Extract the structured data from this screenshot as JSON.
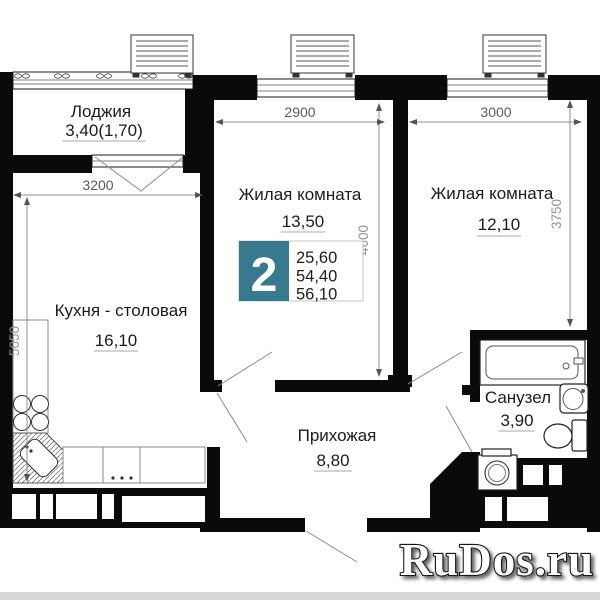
{
  "rooms": [
    {
      "key": "loggia",
      "name": "Лоджия",
      "area": "3,40(1,70)"
    },
    {
      "key": "living1",
      "name": "Жилая комната",
      "area": "13,50"
    },
    {
      "key": "living2",
      "name": "Жилая комната",
      "area": "12,10"
    },
    {
      "key": "kitchen",
      "name": "Кухня - столовая",
      "area": "16,10"
    },
    {
      "key": "hallway",
      "name": "Прихожая",
      "area": "8,80"
    },
    {
      "key": "bathroom",
      "name": "Санузел",
      "area": "3,90"
    }
  ],
  "badge": {
    "room_count": "2",
    "values": [
      "25,60",
      "54,40",
      "56,10"
    ]
  },
  "dims": {
    "living1_width": "2900",
    "living2_width": "3000",
    "kitchen_width": "3200",
    "living1_depth": "4600",
    "living2_depth": "3750",
    "kitchen_depth": "5050"
  },
  "watermark": {
    "text": "RuDos.ru"
  },
  "colors": {
    "badge_teal": "#38798e",
    "wall": "#0a0a0a",
    "watermark_fill": "#ffffff"
  }
}
